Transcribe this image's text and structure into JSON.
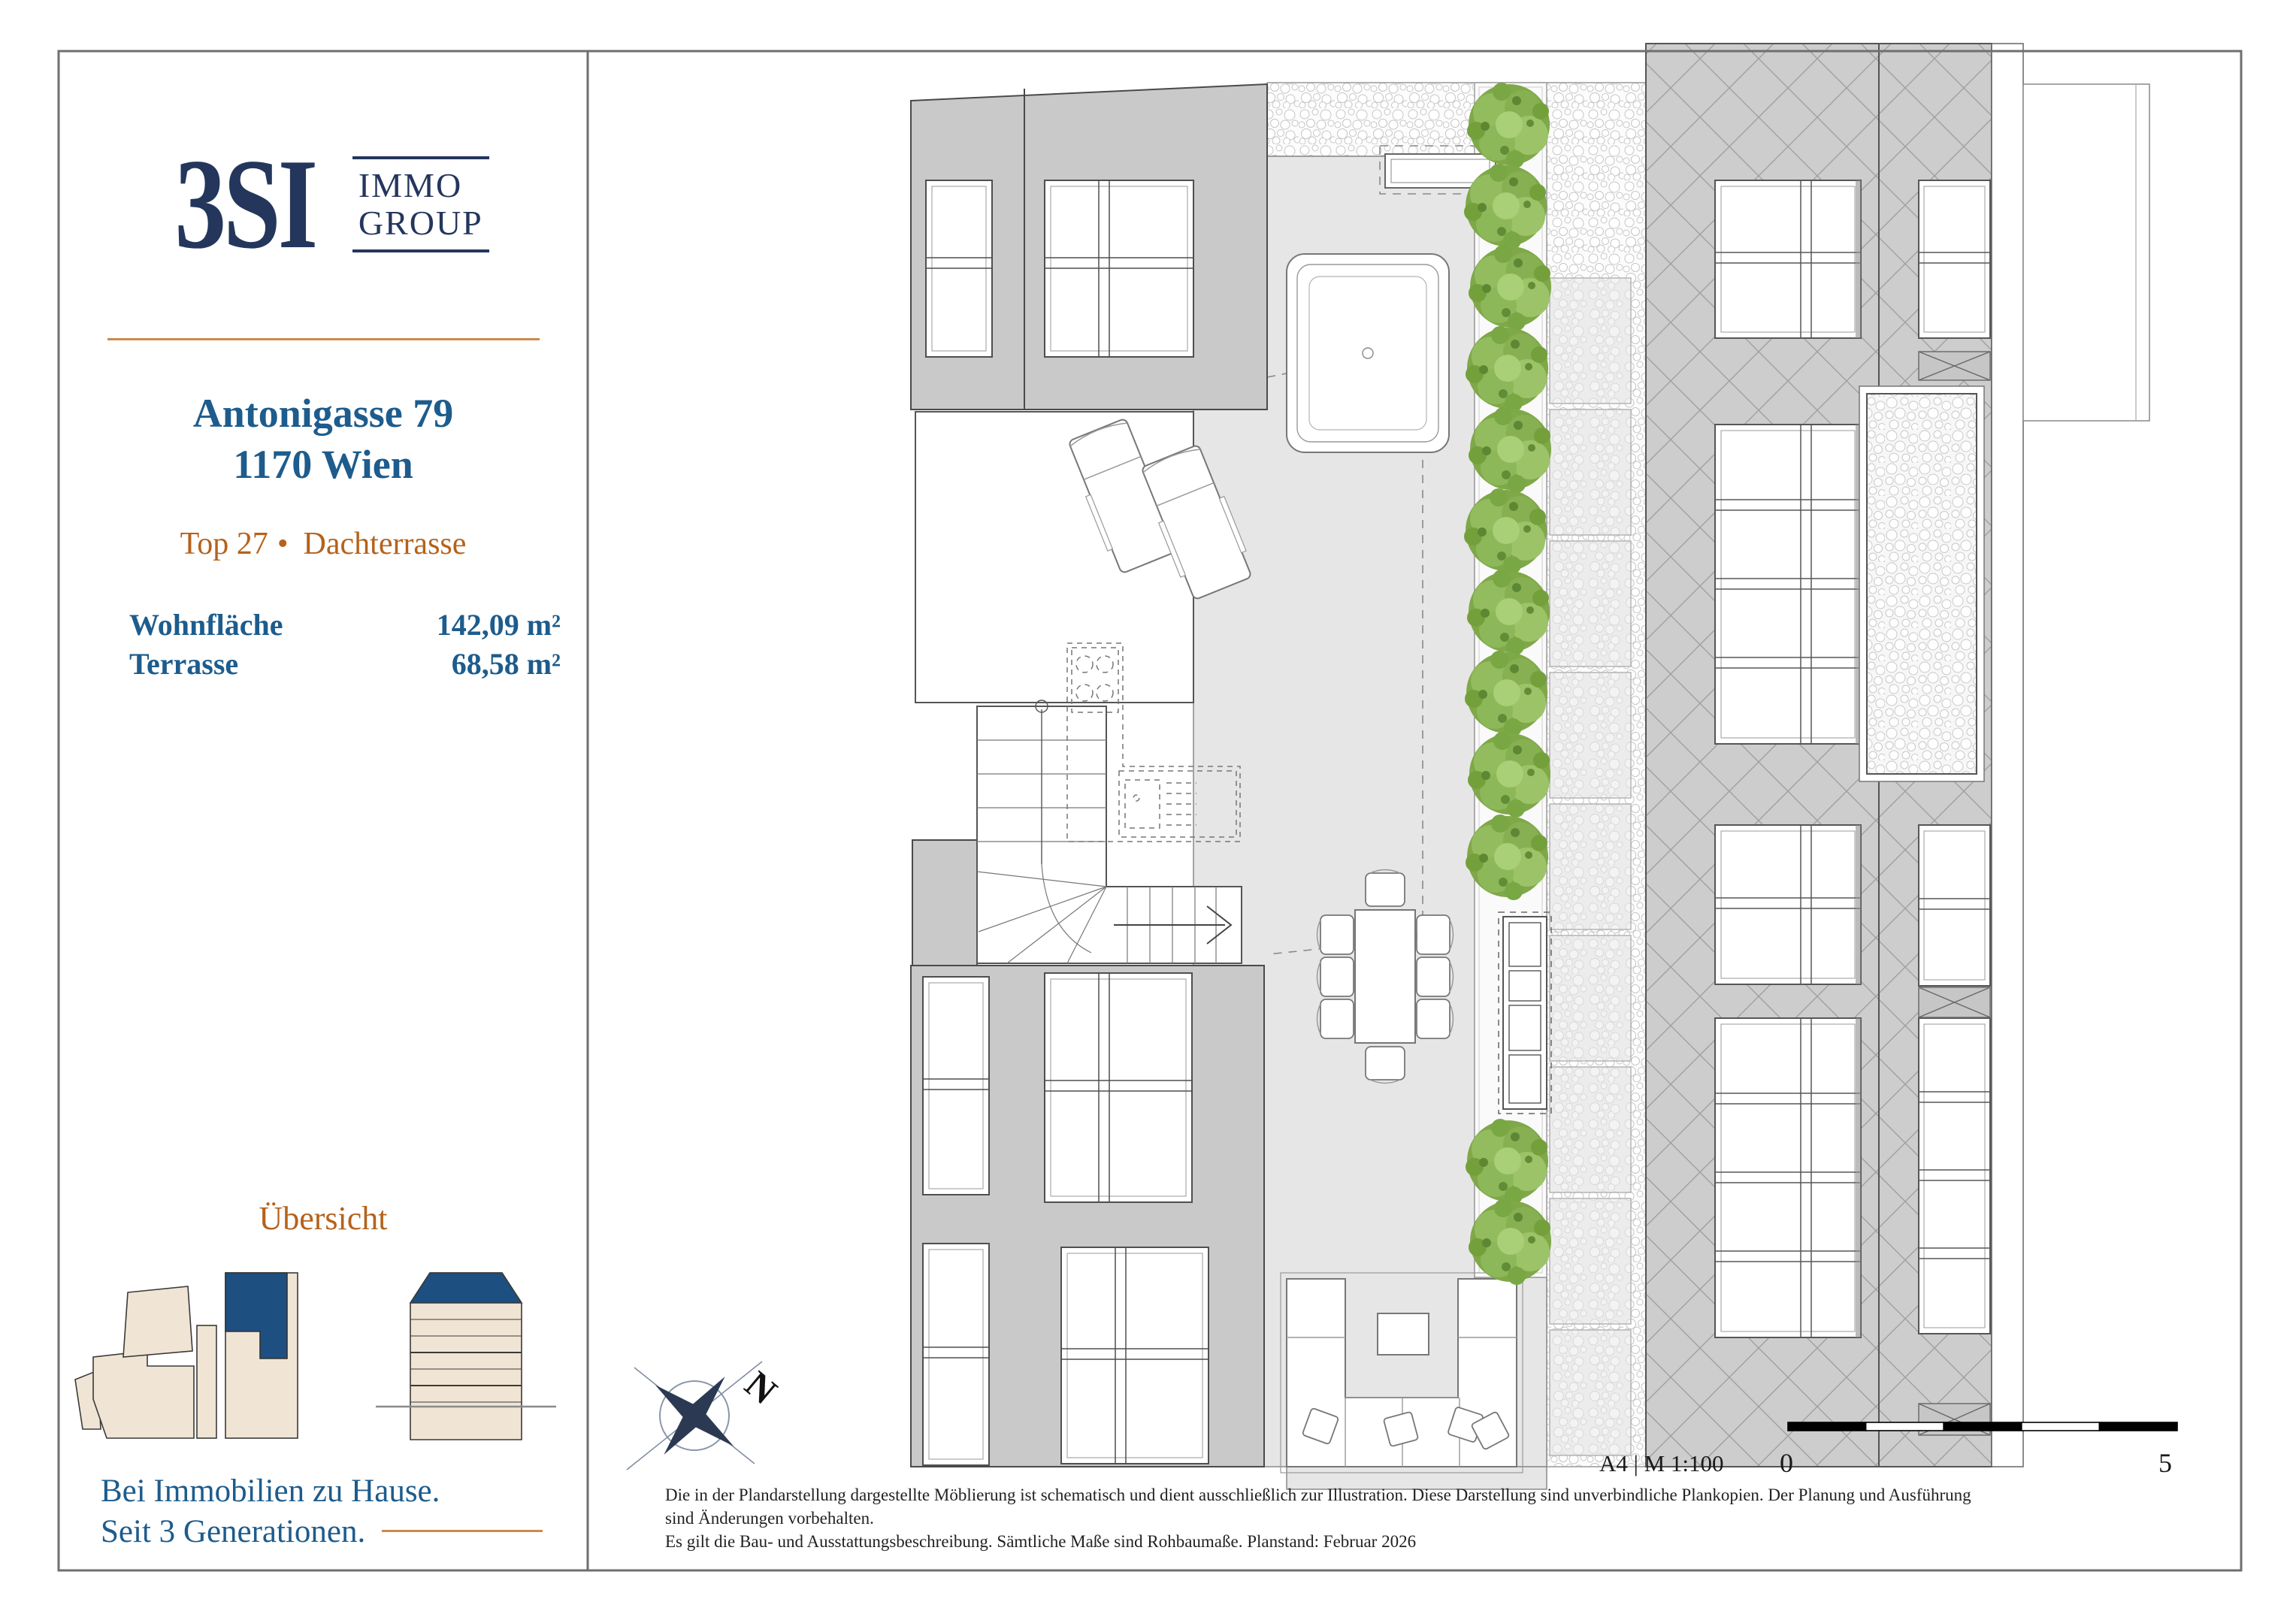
{
  "sidebar": {
    "logo": {
      "brand": "3SI",
      "line1": "IMMO",
      "line2": "GROUP"
    },
    "address": {
      "line1": "Antonigasse 79",
      "line2": "1170 Wien"
    },
    "unit": {
      "top": "Top 27",
      "bullet": "•",
      "type": "Dachterrasse"
    },
    "metrics": [
      {
        "label": "Wohnfläche",
        "value": "142,09 m²"
      },
      {
        "label": "Terrasse",
        "value": "68,58 m²"
      }
    ],
    "overview_title": "Übersicht",
    "tagline": {
      "line1": "Bei Immobilien zu Hause.",
      "line2": "Seit 3 Generationen."
    }
  },
  "plan": {
    "compass_label": "N",
    "scale": {
      "sheet": "A4 | M 1:100",
      "start": "0",
      "end": "5"
    },
    "disclaimer": [
      "Die in der Plandarstellung dargestellte Möblierung ist schematisch und dient ausschließlich zur Illustration. Diese Darstellung sind unverbindliche Plankopien. Der Planung und Ausführung",
      "sind Änderungen vorbehalten.",
      "Es gilt die Bau- und Ausstattungsbeschreibung. Sämtliche Maße sind Rohbaumaße. Planstand: Februar 2026"
    ]
  },
  "colors": {
    "navy": "#24365c",
    "heading_blue": "#1d5c8d",
    "accent_orange": "#b5621b",
    "accent_orange_line": "#cd8a4a",
    "minimap_blue": "#1d4f80",
    "minimap_beige": "#f0e4d4",
    "tree_green": "#7fa849",
    "wall_gray": "#c9c9c9",
    "terrace_gray": "#e6e6e6"
  }
}
